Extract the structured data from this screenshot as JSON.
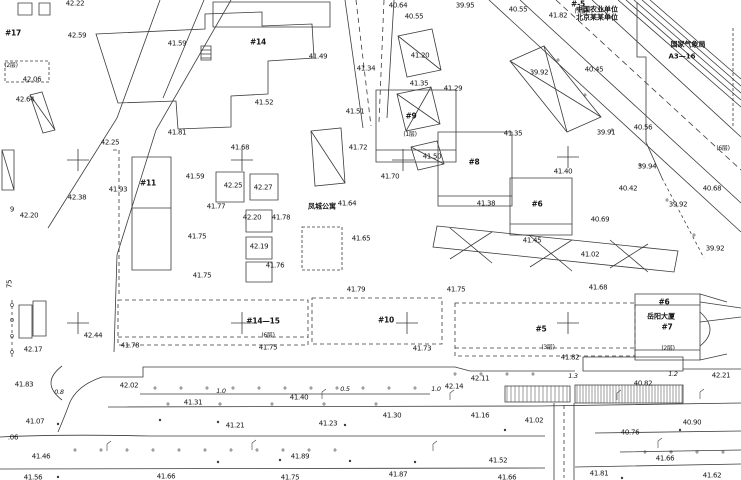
{
  "meta": {
    "drawing_type": "topographic cadastral site plan",
    "bg_color": "#ffffff",
    "line_color": "#3b3b3b",
    "text_color": "#151515"
  },
  "names": [
    {
      "x": 322,
      "y": 207,
      "text": "凤城公寓"
    },
    {
      "x": 661,
      "y": 317,
      "text": "岳阳大厦"
    },
    {
      "x": 688,
      "y": 45,
      "text": "国家气象局"
    },
    {
      "x": 682,
      "y": 57,
      "text": "A3—16"
    },
    {
      "x": 597,
      "y": 10,
      "text": "中国农业单位"
    },
    {
      "x": 597,
      "y": 18,
      "text": "北京某某单位"
    }
  ],
  "buildings": [
    {
      "x": 13,
      "y": 33,
      "label": "#17"
    },
    {
      "x": 258,
      "y": 42,
      "label": "#14"
    },
    {
      "x": 578,
      "y": 4,
      "label": "#-5"
    },
    {
      "x": 411,
      "y": 116,
      "label": "#9"
    },
    {
      "x": 474,
      "y": 162,
      "label": "#8"
    },
    {
      "x": 537,
      "y": 204,
      "label": "#6"
    },
    {
      "x": 148,
      "y": 183,
      "label": "#11"
    },
    {
      "x": 263,
      "y": 321,
      "label": "#14—15"
    },
    {
      "x": 386,
      "y": 320,
      "label": "#10"
    },
    {
      "x": 541,
      "y": 329,
      "label": "#5"
    },
    {
      "x": 667,
      "y": 327,
      "label": "#7"
    },
    {
      "x": 664,
      "y": 302,
      "label": "#6"
    }
  ],
  "floor_notes": [
    {
      "x": 11,
      "y": 66,
      "text": "(2层)"
    },
    {
      "x": 581,
      "y": 12,
      "text": "(7层)"
    },
    {
      "x": 410,
      "y": 135,
      "text": "(1层)"
    },
    {
      "x": 723,
      "y": 149,
      "text": "(6层)"
    },
    {
      "x": 268,
      "y": 336,
      "text": "(6层)"
    },
    {
      "x": 548,
      "y": 348,
      "text": "(3层)"
    },
    {
      "x": 668,
      "y": 349,
      "text": "(2层)"
    }
  ],
  "slope_labels": [
    {
      "x": 59,
      "y": 392,
      "text": "0.8"
    },
    {
      "x": 221,
      "y": 391,
      "text": "1.0"
    },
    {
      "x": 345,
      "y": 389,
      "text": "0.5"
    },
    {
      "x": 436,
      "y": 389,
      "text": "1.0"
    },
    {
      "x": 573,
      "y": 376,
      "text": "1.3"
    },
    {
      "x": 673,
      "y": 374,
      "text": "1.2"
    }
  ],
  "rotated_labels": [
    {
      "x": 10,
      "y": 284,
      "text": "75"
    }
  ],
  "spot_heights": [
    {
      "x": 75,
      "y": 4,
      "text": "42.22"
    },
    {
      "x": 77,
      "y": 36,
      "text": "42.59"
    },
    {
      "x": 177,
      "y": 44,
      "text": "41.59"
    },
    {
      "x": 32,
      "y": 80,
      "text": "42.06"
    },
    {
      "x": 25,
      "y": 100,
      "text": "42.64"
    },
    {
      "x": 398,
      "y": 6,
      "text": "40.64"
    },
    {
      "x": 414,
      "y": 17,
      "text": "40.55"
    },
    {
      "x": 465,
      "y": 6,
      "text": "39.95"
    },
    {
      "x": 518,
      "y": 10,
      "text": "40.55"
    },
    {
      "x": 558,
      "y": 16,
      "text": "41.82"
    },
    {
      "x": 594,
      "y": 70,
      "text": "40.45"
    },
    {
      "x": 539,
      "y": 73,
      "text": "39.92"
    },
    {
      "x": 643,
      "y": 128,
      "text": "40.56"
    },
    {
      "x": 606,
      "y": 133,
      "text": "39.91"
    },
    {
      "x": 647,
      "y": 167,
      "text": "39.94"
    },
    {
      "x": 628,
      "y": 189,
      "text": "40.42"
    },
    {
      "x": 678,
      "y": 205,
      "text": "39.92"
    },
    {
      "x": 712,
      "y": 189,
      "text": "40.68"
    },
    {
      "x": 715,
      "y": 249,
      "text": "39.92"
    },
    {
      "x": 600,
      "y": 220,
      "text": "40.69"
    },
    {
      "x": 264,
      "y": 103,
      "text": "41.52"
    },
    {
      "x": 318,
      "y": 57,
      "text": "41.49"
    },
    {
      "x": 366,
      "y": 69,
      "text": "41.34"
    },
    {
      "x": 420,
      "y": 56,
      "text": "41.20"
    },
    {
      "x": 419,
      "y": 84,
      "text": "41.35"
    },
    {
      "x": 453,
      "y": 89,
      "text": "41.29"
    },
    {
      "x": 355,
      "y": 112,
      "text": "41.51"
    },
    {
      "x": 110,
      "y": 143,
      "text": "42.25"
    },
    {
      "x": 177,
      "y": 133,
      "text": "41.81"
    },
    {
      "x": 240,
      "y": 148,
      "text": "41.68"
    },
    {
      "x": 77,
      "y": 198,
      "text": "42.38"
    },
    {
      "x": 118,
      "y": 190,
      "text": "41.93"
    },
    {
      "x": 195,
      "y": 177,
      "text": "41.59"
    },
    {
      "x": 233,
      "y": 186,
      "text": "42.25"
    },
    {
      "x": 263,
      "y": 188,
      "text": "42.27"
    },
    {
      "x": 216,
      "y": 207,
      "text": "41.77"
    },
    {
      "x": 197,
      "y": 237,
      "text": "41.75"
    },
    {
      "x": 281,
      "y": 218,
      "text": "41.78"
    },
    {
      "x": 252,
      "y": 218,
      "text": "42.20"
    },
    {
      "x": 259,
      "y": 247,
      "text": "42.19"
    },
    {
      "x": 275,
      "y": 266,
      "text": "41.76"
    },
    {
      "x": 347,
      "y": 204,
      "text": "41.64"
    },
    {
      "x": 361,
      "y": 239,
      "text": "41.65"
    },
    {
      "x": 358,
      "y": 148,
      "text": "41.72"
    },
    {
      "x": 390,
      "y": 177,
      "text": "41.70"
    },
    {
      "x": 432,
      "y": 157,
      "text": "41.50"
    },
    {
      "x": 513,
      "y": 134,
      "text": "41.35"
    },
    {
      "x": 563,
      "y": 172,
      "text": "41.40"
    },
    {
      "x": 486,
      "y": 204,
      "text": "41.38"
    },
    {
      "x": 532,
      "y": 241,
      "text": "41.45"
    },
    {
      "x": 590,
      "y": 255,
      "text": "41.02"
    },
    {
      "x": 598,
      "y": 288,
      "text": "41.68"
    },
    {
      "x": 202,
      "y": 276,
      "text": "41.75"
    },
    {
      "x": 356,
      "y": 290,
      "text": "41.79"
    },
    {
      "x": 456,
      "y": 290,
      "text": "41.75"
    },
    {
      "x": 130,
      "y": 346,
      "text": "41.78"
    },
    {
      "x": 93,
      "y": 336,
      "text": "42.44"
    },
    {
      "x": 33,
      "y": 350,
      "text": "42.17"
    },
    {
      "x": 268,
      "y": 348,
      "text": "41.75"
    },
    {
      "x": 422,
      "y": 349,
      "text": "41.73"
    },
    {
      "x": 570,
      "y": 358,
      "text": "41.82"
    },
    {
      "x": 721,
      "y": 376,
      "text": "42.21"
    },
    {
      "x": 643,
      "y": 384,
      "text": "40.82"
    },
    {
      "x": 480,
      "y": 379,
      "text": "42.11"
    },
    {
      "x": 454,
      "y": 387,
      "text": "42.14"
    },
    {
      "x": 24,
      "y": 385,
      "text": "41.83"
    },
    {
      "x": 129,
      "y": 386,
      "text": "42.02"
    },
    {
      "x": 193,
      "y": 403,
      "text": "41.31"
    },
    {
      "x": 299,
      "y": 398,
      "text": "41.40"
    },
    {
      "x": 35,
      "y": 422,
      "text": "41.07"
    },
    {
      "x": 235,
      "y": 426,
      "text": "41.21"
    },
    {
      "x": 328,
      "y": 424,
      "text": "41.23"
    },
    {
      "x": 392,
      "y": 416,
      "text": "41.30"
    },
    {
      "x": 480,
      "y": 416,
      "text": "41.16"
    },
    {
      "x": 534,
      "y": 421,
      "text": "41.02"
    },
    {
      "x": 692,
      "y": 423,
      "text": "40.90"
    },
    {
      "x": 630,
      "y": 433,
      "text": "40.76"
    },
    {
      "x": 41,
      "y": 457,
      "text": "41.46"
    },
    {
      "x": 300,
      "y": 457,
      "text": "41.89"
    },
    {
      "x": 498,
      "y": 461,
      "text": "41.52"
    },
    {
      "x": 665,
      "y": 459,
      "text": "41.66"
    },
    {
      "x": 33,
      "y": 478,
      "text": "41.56"
    },
    {
      "x": 166,
      "y": 477,
      "text": "41.66"
    },
    {
      "x": 290,
      "y": 478,
      "text": "41.75"
    },
    {
      "x": 398,
      "y": 475,
      "text": "41.87"
    },
    {
      "x": 507,
      "y": 478,
      "text": "41.66"
    },
    {
      "x": 599,
      "y": 474,
      "text": "41.81"
    },
    {
      "x": 712,
      "y": 476,
      "text": "41.62"
    },
    {
      "x": 12,
      "y": 210,
      "text": "9"
    },
    {
      "x": 29,
      "y": 216,
      "text": "42.20"
    },
    {
      "x": 13,
      "y": 438,
      "text": ".06"
    }
  ],
  "crosses": [
    {
      "x": 78,
      "y": 160
    },
    {
      "x": 242,
      "y": 160
    },
    {
      "x": 403,
      "y": 160
    },
    {
      "x": 568,
      "y": 157
    },
    {
      "x": 78,
      "y": 323
    },
    {
      "x": 242,
      "y": 323
    },
    {
      "x": 407,
      "y": 323
    },
    {
      "x": 568,
      "y": 323
    }
  ]
}
